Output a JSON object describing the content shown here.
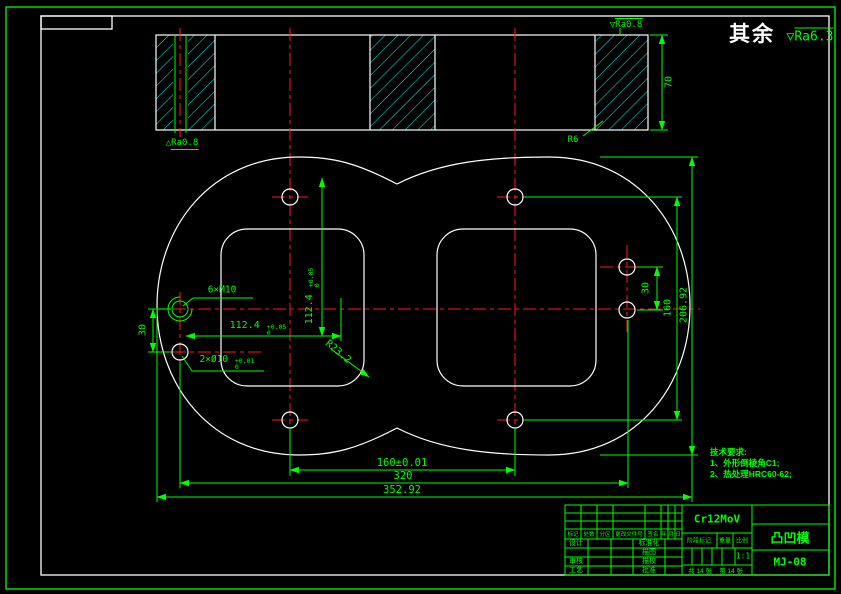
{
  "general": {
    "surplus_label": "其余",
    "surface_symbol": "▽",
    "surface_value": "Ra6.3"
  },
  "section": {
    "height_dim": "70",
    "radius_label": "R6",
    "finish_top_symbol": "▽",
    "finish_top_value": "Ra0.8",
    "finish_bottom_symbol": "△",
    "finish_bottom_value": "Ra0.8"
  },
  "plan": {
    "thread_label": "6×M10",
    "dowel_label": "2×Ø10",
    "dowel_tol_upper": "+0.01",
    "dowel_tol_lower": "0",
    "cavity_width": "112.4",
    "cavity_width_tol_upper": "+0.05",
    "cavity_width_tol_lower": "0",
    "cavity_height": "112.4",
    "cavity_height_tol_upper": "+0.05",
    "cavity_height_tol_lower": "0",
    "corner_radius": "R23.2",
    "left_hole_pitch": "30",
    "right_hole_pitch": "30",
    "row_pitch": "160",
    "overall_height": "206.92",
    "bottom_hole_pitch": "160±0.01",
    "column_pitch": "320",
    "overall_width": "352.92"
  },
  "tech": {
    "title": "技术要求:",
    "line1": "1、外形倒棱角C1;",
    "line2": "2、热处理HRC60-62;"
  },
  "titleblock": {
    "material": "Cr12MoV",
    "part_name": "凸凹模",
    "drawing_no": "MJ-08",
    "rev_headers": [
      "标记",
      "处数",
      "分区",
      "更改文件号",
      "签名",
      "年",
      "月",
      "日"
    ],
    "row1_left": "设计",
    "row1_mid": "标准化",
    "row2_mid": "描图",
    "row3_left": "审核",
    "row3_mid": "描校",
    "row4_left": "工艺",
    "row4_mid": "批准",
    "stage_label": "阶段标记",
    "weight_label": "重量",
    "scale_label": "比例",
    "scale_value": "1:1",
    "sheet_total": "共 14 张",
    "sheet_no": "第 14 张"
  },
  "colors": {
    "dimension": "#00ff00",
    "outline": "#ffffff",
    "centerline": "#ff0000",
    "hatch": "#00e5e5",
    "background": "#000000"
  }
}
